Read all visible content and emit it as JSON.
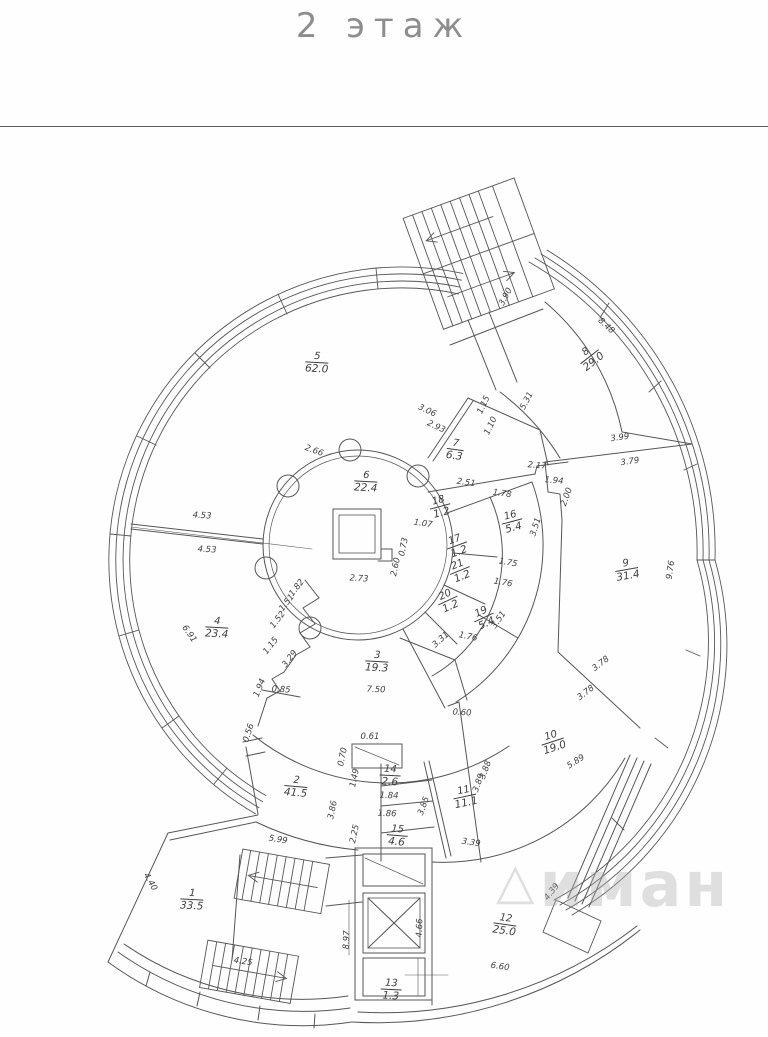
{
  "page": {
    "title": "2 этаж"
  },
  "watermark": {
    "logo": "△",
    "text": "иман"
  },
  "plan": {
    "rooms": [
      {
        "n": "1",
        "area": "33.5",
        "x": 192,
        "y": 900,
        "rot": 3
      },
      {
        "n": "2",
        "area": "41.5",
        "x": 296,
        "y": 787,
        "rot": 5
      },
      {
        "n": "3",
        "area": "19.3",
        "x": 377,
        "y": 662,
        "rot": 3
      },
      {
        "n": "4",
        "area": "23.4",
        "x": 217,
        "y": 628,
        "rot": 3
      },
      {
        "n": "5",
        "area": "62.0",
        "x": 317,
        "y": 363,
        "rot": 3
      },
      {
        "n": "6",
        "area": "22.4",
        "x": 366,
        "y": 482,
        "rot": 3
      },
      {
        "n": "7",
        "area": "6.3",
        "x": 455,
        "y": 450,
        "rot": 8
      },
      {
        "n": "8",
        "area": "29.0",
        "x": 590,
        "y": 357,
        "rot": -38
      },
      {
        "n": "9",
        "area": "31.4",
        "x": 627,
        "y": 570,
        "rot": -10
      },
      {
        "n": "10",
        "area": "19.0",
        "x": 553,
        "y": 742,
        "rot": -18
      },
      {
        "n": "11",
        "area": "11.1",
        "x": 465,
        "y": 797,
        "rot": -12
      },
      {
        "n": "12",
        "area": "25.0",
        "x": 505,
        "y": 925,
        "rot": 8
      },
      {
        "n": "13",
        "area": "1.3",
        "x": 391,
        "y": 990,
        "rot": 3
      },
      {
        "n": "14",
        "area": "2.6",
        "x": 390,
        "y": 776,
        "rot": 3
      },
      {
        "n": "15",
        "area": "4.6",
        "x": 397,
        "y": 836,
        "rot": 5
      },
      {
        "n": "16",
        "area": "5.4",
        "x": 512,
        "y": 522,
        "rot": -15
      },
      {
        "n": "17",
        "area": "1.2",
        "x": 457,
        "y": 546,
        "rot": -20
      },
      {
        "n": "18",
        "area": "1.2",
        "x": 440,
        "y": 507,
        "rot": -15
      },
      {
        "n": "19",
        "area": "5.4",
        "x": 484,
        "y": 618,
        "rot": -25
      },
      {
        "n": "20",
        "area": "1.2",
        "x": 448,
        "y": 601,
        "rot": -25
      },
      {
        "n": "21",
        "area": "1.2",
        "x": 460,
        "y": 571,
        "rot": -22
      }
    ],
    "dimensions": [
      {
        "t": "3.90",
        "x": 506,
        "y": 297,
        "rot": -62
      },
      {
        "t": "5.31",
        "x": 527,
        "y": 401,
        "rot": -62
      },
      {
        "t": "8.48",
        "x": 606,
        "y": 326,
        "rot": 42
      },
      {
        "t": "3.06",
        "x": 427,
        "y": 411,
        "rot": 25
      },
      {
        "t": "2.93",
        "x": 436,
        "y": 427,
        "rot": 25
      },
      {
        "t": "1.15",
        "x": 484,
        "y": 405,
        "rot": -65
      },
      {
        "t": "1.10",
        "x": 491,
        "y": 426,
        "rot": -65
      },
      {
        "t": "2.66",
        "x": 314,
        "y": 451,
        "rot": 20
      },
      {
        "t": "2.17",
        "x": 537,
        "y": 466,
        "rot": 5
      },
      {
        "t": "1.94",
        "x": 554,
        "y": 481,
        "rot": 5
      },
      {
        "t": "2.00",
        "x": 567,
        "y": 497,
        "rot": -70
      },
      {
        "t": "2.51",
        "x": 466,
        "y": 483,
        "rot": 8
      },
      {
        "t": "1.78",
        "x": 502,
        "y": 494,
        "rot": 8
      },
      {
        "t": "1.07",
        "x": 423,
        "y": 524,
        "rot": 8
      },
      {
        "t": "3.51",
        "x": 536,
        "y": 527,
        "rot": -72
      },
      {
        "t": "1.75",
        "x": 508,
        "y": 563,
        "rot": 10
      },
      {
        "t": "1.76",
        "x": 503,
        "y": 583,
        "rot": 10
      },
      {
        "t": "3.51",
        "x": 499,
        "y": 620,
        "rot": -55
      },
      {
        "t": "1.76",
        "x": 468,
        "y": 637,
        "rot": 12
      },
      {
        "t": "3.31",
        "x": 441,
        "y": 640,
        "rot": -42
      },
      {
        "t": "0.73",
        "x": 404,
        "y": 547,
        "rot": -78
      },
      {
        "t": "2.60",
        "x": 396,
        "y": 567,
        "rot": -78
      },
      {
        "t": "2.73",
        "x": 359,
        "y": 579,
        "rot": 4
      },
      {
        "t": "4.53",
        "x": 202,
        "y": 516,
        "rot": 3
      },
      {
        "t": "4.53",
        "x": 207,
        "y": 550,
        "rot": 3
      },
      {
        "t": "6.91",
        "x": 189,
        "y": 634,
        "rot": 55
      },
      {
        "t": "1.82",
        "x": 297,
        "y": 588,
        "rot": -52
      },
      {
        "t": "1.51",
        "x": 287,
        "y": 603,
        "rot": -52
      },
      {
        "t": "1.52",
        "x": 278,
        "y": 620,
        "rot": -52
      },
      {
        "t": "1.15",
        "x": 271,
        "y": 646,
        "rot": -52
      },
      {
        "t": "3.29",
        "x": 290,
        "y": 659,
        "rot": -52
      },
      {
        "t": "1.94",
        "x": 260,
        "y": 688,
        "rot": -68
      },
      {
        "t": "0.85",
        "x": 281,
        "y": 690,
        "rot": 4
      },
      {
        "t": "0.56",
        "x": 249,
        "y": 733,
        "rot": -72
      },
      {
        "t": "5.99",
        "x": 278,
        "y": 840,
        "rot": 10
      },
      {
        "t": "4.40",
        "x": 150,
        "y": 882,
        "rot": 60
      },
      {
        "t": "4.25",
        "x": 243,
        "y": 962,
        "rot": 8
      },
      {
        "t": "0.61",
        "x": 370,
        "y": 737,
        "rot": 0
      },
      {
        "t": "0.70",
        "x": 343,
        "y": 757,
        "rot": -78
      },
      {
        "t": "1.49",
        "x": 355,
        "y": 778,
        "rot": -78
      },
      {
        "t": "3.86",
        "x": 333,
        "y": 810,
        "rot": -78
      },
      {
        "t": "2.25",
        "x": 355,
        "y": 834,
        "rot": -78
      },
      {
        "t": "1.84",
        "x": 389,
        "y": 796,
        "rot": 2
      },
      {
        "t": "1.86",
        "x": 387,
        "y": 814,
        "rot": 2
      },
      {
        "t": "3.85",
        "x": 424,
        "y": 806,
        "rot": -70
      },
      {
        "t": "3.88",
        "x": 486,
        "y": 770,
        "rot": -70
      },
      {
        "t": "3.89",
        "x": 479,
        "y": 783,
        "rot": -70
      },
      {
        "t": "3.39",
        "x": 471,
        "y": 843,
        "rot": 8
      },
      {
        "t": "0.60",
        "x": 462,
        "y": 713,
        "rot": 4
      },
      {
        "t": "3.78",
        "x": 601,
        "y": 664,
        "rot": -38
      },
      {
        "t": "3.78",
        "x": 586,
        "y": 693,
        "rot": -38
      },
      {
        "t": "5.89",
        "x": 576,
        "y": 762,
        "rot": -32
      },
      {
        "t": "3.99",
        "x": 620,
        "y": 438,
        "rot": -8
      },
      {
        "t": "3.79",
        "x": 630,
        "y": 462,
        "rot": -8
      },
      {
        "t": "9.76",
        "x": 671,
        "y": 570,
        "rot": -82
      },
      {
        "t": "7.50",
        "x": 376,
        "y": 690,
        "rot": 2
      },
      {
        "t": "6.60",
        "x": 500,
        "y": 967,
        "rot": 8
      },
      {
        "t": "4.39",
        "x": 552,
        "y": 892,
        "rot": -52
      },
      {
        "t": "8.97",
        "x": 347,
        "y": 940,
        "rot": -88
      },
      {
        "t": "4.66",
        "x": 420,
        "y": 928,
        "rot": -88
      }
    ]
  }
}
